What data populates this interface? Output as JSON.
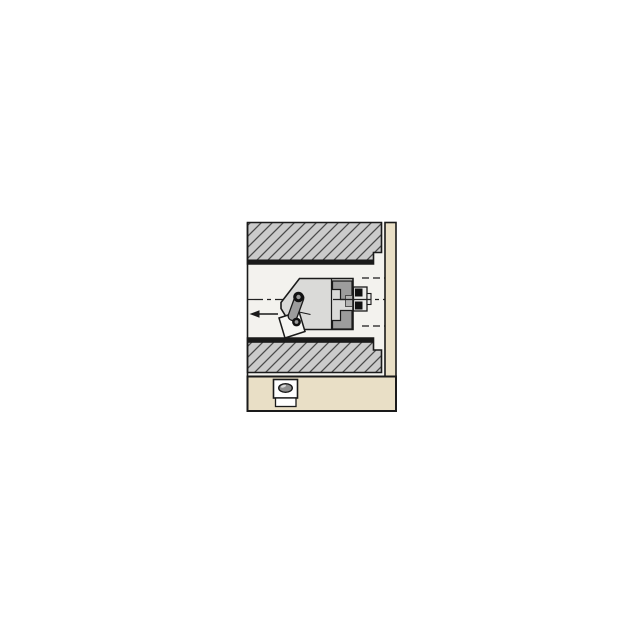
{
  "meta": {
    "type": "technical-illustration",
    "subject": "Cross-section view of an internal boring/turning tool head with indexable insert cutting inside a workpiece bore; plan view of insert pocket on shank below",
    "visible_text": ""
  },
  "annotations": {
    "feed_arrow_direction": "left",
    "centerline_style": "dash-dot",
    "hidden_lines": "dashed bore continuation at right side"
  },
  "colors": {
    "page_bg": "#ffffff",
    "bore_bg": "#f3f2ee",
    "workpiece_fill": "#cbcbcb",
    "hatch_line": "#4a4a4a",
    "outline": "#1a1a1a",
    "machined_surface": "#1a1a1a",
    "fixture_tan": "#e9dfc6",
    "tool_body": "#dadad8",
    "clamp_gray": "#9c9c9c",
    "coupling_gray": "#9c9c9c",
    "hub_gray": "#b3b3b2",
    "knob_face": "#ececea",
    "insert_white": "#f6f6f3",
    "screw_black": "#111111",
    "screw_center": "#999999",
    "insert_top_view_fill": "#8f8f8f",
    "insert_top_view_highlight": "#d8d8d8",
    "centerline": "#222222"
  }
}
